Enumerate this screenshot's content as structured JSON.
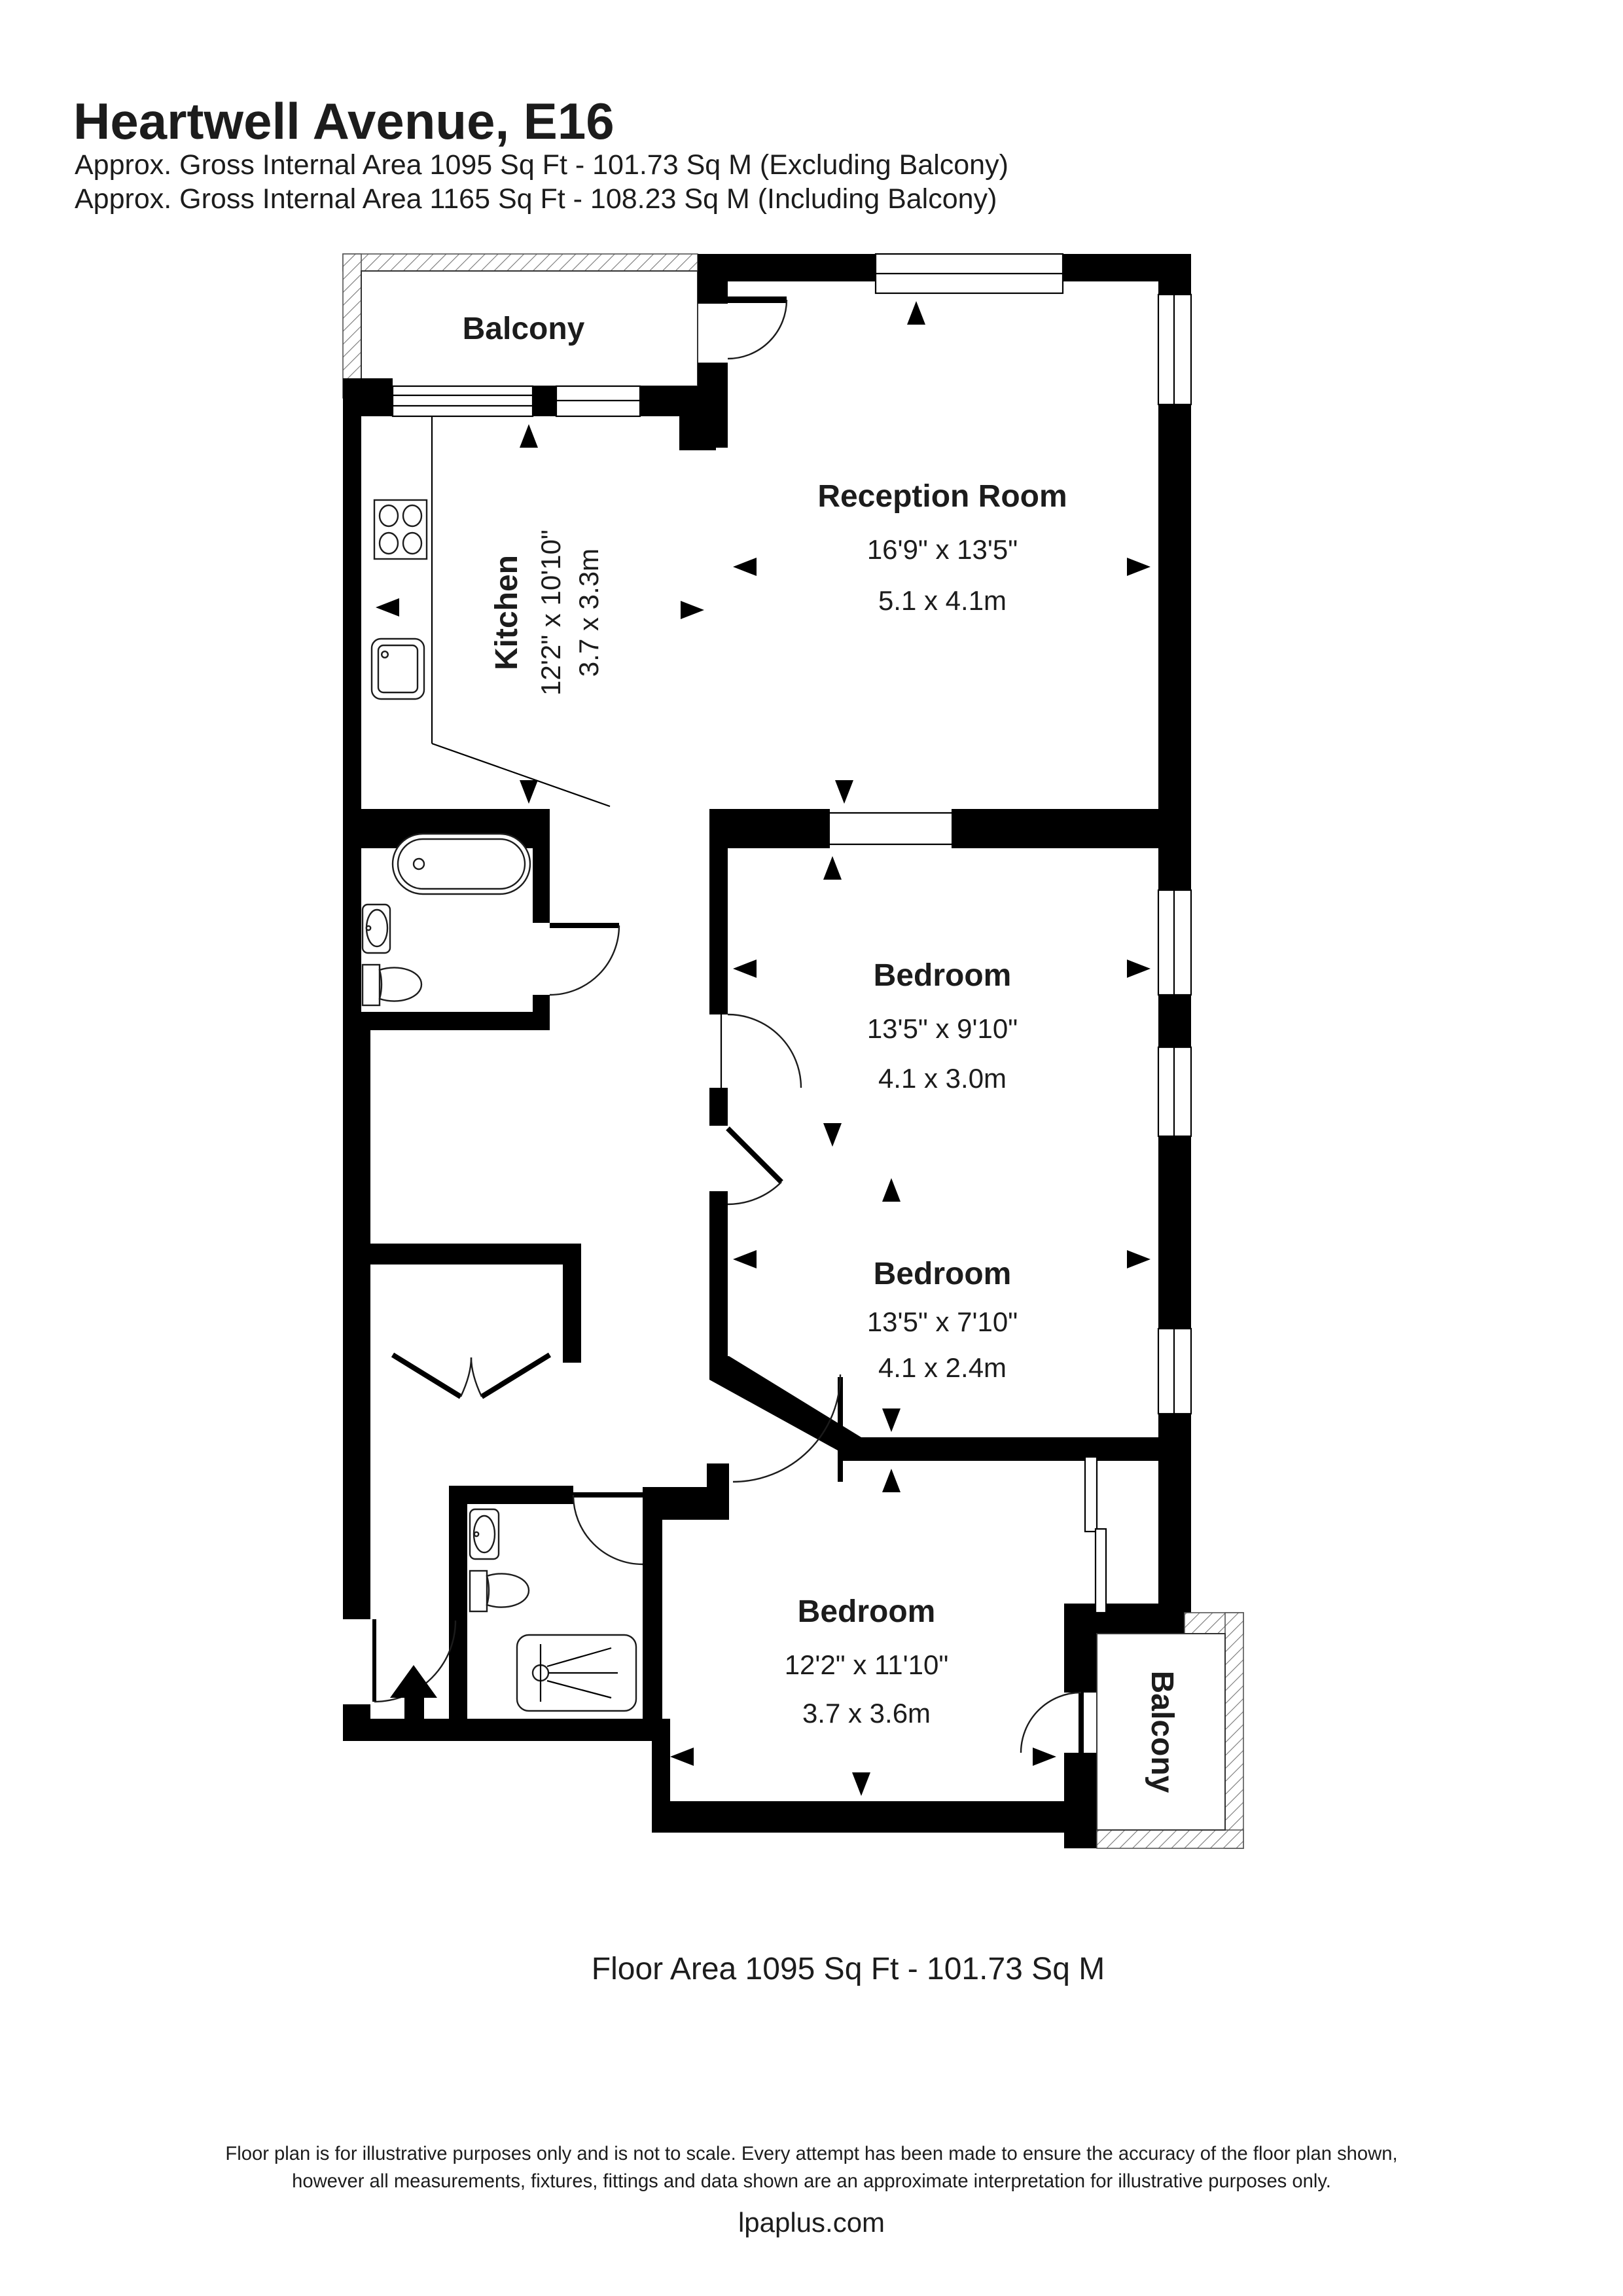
{
  "header": {
    "title": "Heartwell Avenue, E16",
    "subtitle_excluding": "Approx. Gross Internal Area 1095 Sq Ft - 101.73 Sq M (Excluding Balcony)",
    "subtitle_including": "Approx. Gross Internal Area 1165 Sq Ft - 108.23 Sq M (Including Balcony)"
  },
  "rooms": {
    "balcony_top": {
      "name": "Balcony"
    },
    "kitchen": {
      "name": "Kitchen",
      "imperial": "12'2\" x 10'10\"",
      "metric": "3.7 x 3.3m"
    },
    "reception": {
      "name": "Reception Room",
      "imperial": "16'9\" x 13'5\"",
      "metric": "5.1 x 4.1m"
    },
    "bedroom1": {
      "name": "Bedroom",
      "imperial": "13'5\" x 9'10\"",
      "metric": "4.1 x 3.0m"
    },
    "bedroom2": {
      "name": "Bedroom",
      "imperial": "13'5\" x 7'10\"",
      "metric": "4.1 x 2.4m"
    },
    "bedroom3": {
      "name": "Bedroom",
      "imperial": "12'2\" x 11'10\"",
      "metric": "3.7 x 3.6m"
    },
    "balcony_bottom": {
      "name": "Balcony"
    }
  },
  "footer": {
    "floor_area": "Floor Area 1095 Sq Ft - 101.73 Sq M",
    "disclaimer_line1": "Floor plan is for illustrative purposes only and is not to scale. Every attempt has been made to ensure the accuracy of the floor plan shown,",
    "disclaimer_line2": "however all measurements, fixtures, fittings and data shown are an approximate interpretation for illustrative purposes only.",
    "website": "lpaplus.com"
  },
  "colors": {
    "wall": "#000000",
    "text": "#1c1c1c",
    "background": "#ffffff"
  }
}
